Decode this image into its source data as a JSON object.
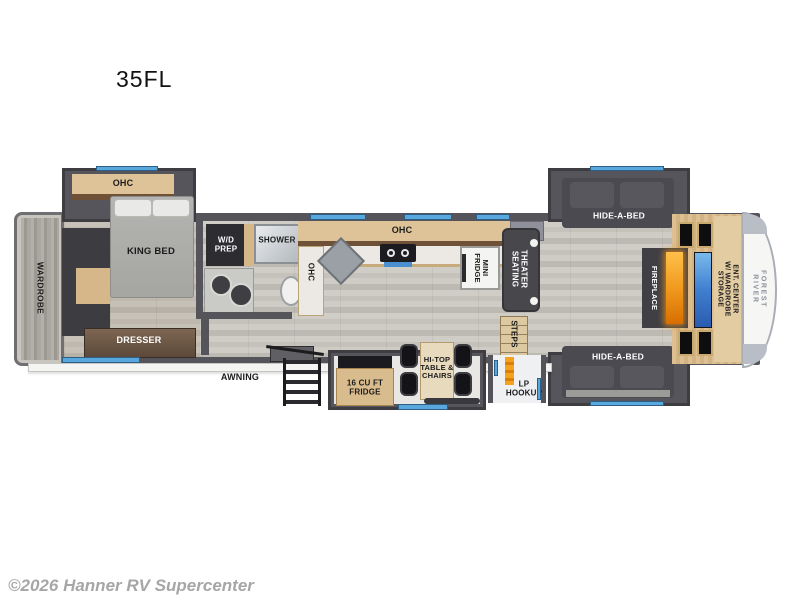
{
  "model": "35FL",
  "watermark": "©2026 Hanner RV Supercenter",
  "brand": "FOREST RIVER",
  "labels": {
    "wardrobe": "WARDROBE",
    "bedroom_ohc": "OHC",
    "king_bed": "KING BED",
    "dresser": "DRESSER",
    "wd_prep": "W/D\nPREP",
    "shower": "SHOWER",
    "kitchen_ohc_top": "OHC",
    "kitchen_ohc_side": "OHC",
    "mini_fridge": "MINI\nFRIDGE",
    "theater_seating": "THEATER\nSEATING",
    "steps": "STEPS",
    "hide_a_bed_top": "HIDE-A-BED",
    "hide_a_bed_bottom": "HIDE-A-BED",
    "fireplace": "FIREPLACE",
    "ent_center": "ENT. CENTER\nW/ WARDROBE STORAGE",
    "awning": "AWNING",
    "fridge_16": "16 CU FT\nFRIDGE",
    "hi_top_table": "HI-TOP\nTABLE &\nCHAIRS",
    "lp_hookup": "LP\nHOOKUP"
  },
  "colors": {
    "wall": "#54545a",
    "cabinet_wood": "#d9bc8e",
    "window_accent": "#58a8de",
    "fireplace_glow": "#f09a1e",
    "tv_screen": "#3f7fd0",
    "floor": "#cbc8c2"
  }
}
